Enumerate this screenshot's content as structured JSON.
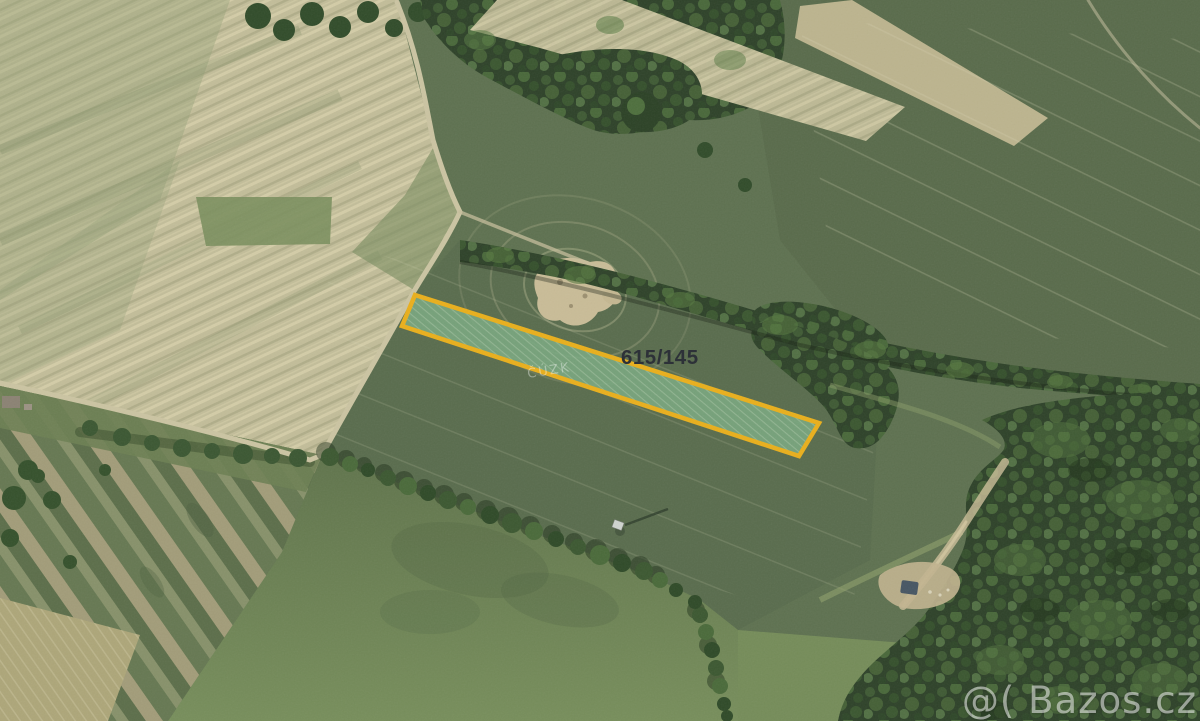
{
  "map": {
    "kind": "aerial-cadastral-photo",
    "parcel": {
      "label": "615/145",
      "outline_color": "#e9af1c",
      "fill_color": "#7aa981"
    },
    "watermarks": {
      "cadastre": "ČÚZK",
      "portal": "@( Bazos.cz"
    },
    "palette": {
      "field_green": "#5e7150",
      "pale_field": "#c2bd99",
      "forest": "#2e4229"
    }
  }
}
